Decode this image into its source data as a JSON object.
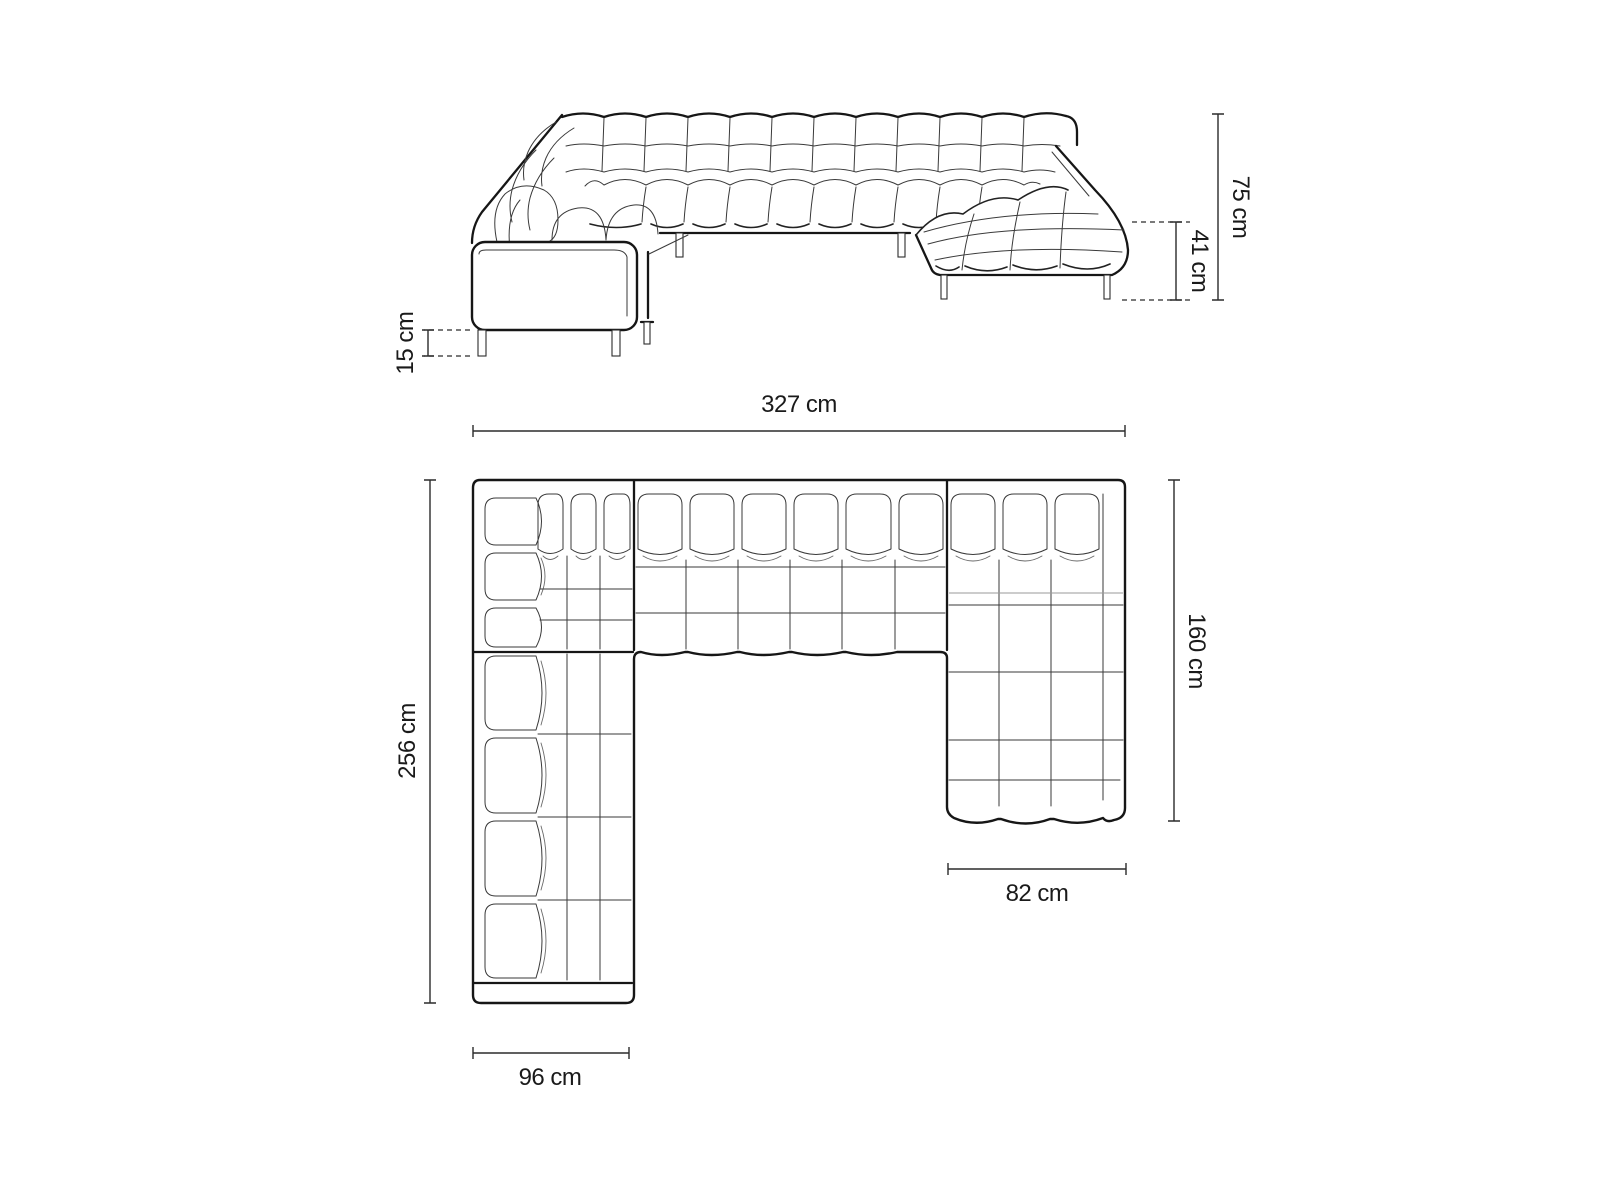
{
  "title": "U-shaped sofa technical dimensions diagram",
  "background": "#ffffff",
  "line_color": "#1a1a1a",
  "views": {
    "elevation": {
      "name": "front-elevation",
      "dimensions": {
        "total_height": {
          "label": "75 cm",
          "orientation": "vertical-right"
        },
        "seat_height": {
          "label": "41 cm",
          "orientation": "vertical-right"
        },
        "leg_height": {
          "label": "15 cm",
          "orientation": "vertical-left"
        }
      }
    },
    "plan": {
      "name": "top-plan-view",
      "dimensions": {
        "total_width": {
          "label": "327 cm",
          "orientation": "horizontal-top"
        },
        "left_side_depth": {
          "label": "256 cm",
          "orientation": "vertical-left"
        },
        "right_side_depth": {
          "label": "160 cm",
          "orientation": "vertical-right"
        },
        "left_module_width": {
          "label": "96 cm",
          "orientation": "horizontal-bottom"
        },
        "chaise_module_width": {
          "label": "82 cm",
          "orientation": "horizontal-bottom"
        }
      }
    }
  }
}
